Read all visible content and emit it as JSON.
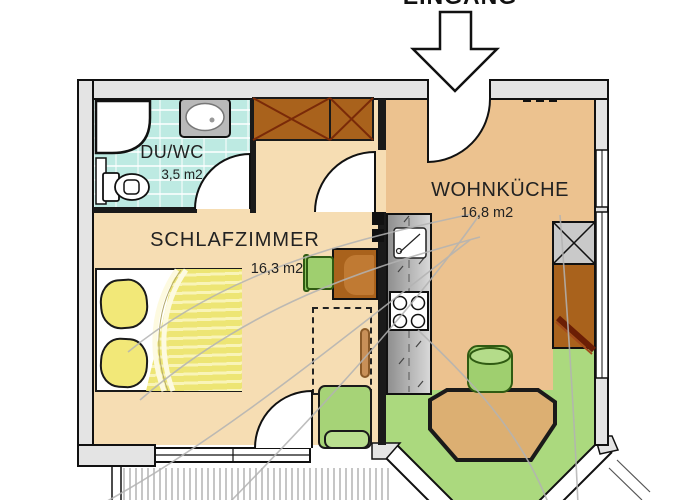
{
  "plan_title": "apartment floor plan",
  "entrance": {
    "label": "EINGANG"
  },
  "rooms": {
    "bath": {
      "name": "DU/WC",
      "area": "3,5 m2"
    },
    "bedroom": {
      "name": "SCHLAFZIMMER",
      "area": "16,3 m2"
    },
    "kitchen": {
      "name": "WOHNKÜCHE",
      "area": "16,8 m2"
    }
  },
  "colors": {
    "wall_fill": "#E4E4E4",
    "wall_line": "#1A1A1A",
    "floor_bedroom": "#F6DDB3",
    "floor_kitchen": "#ECC28F",
    "floor_bath_tile": "#BDEAE2",
    "floor_green": "#ABD97E",
    "furniture_brown": "#A9621C",
    "furniture_green": "#A6D377",
    "bed_yellow": "#F2E878",
    "counter_gray": "#B5B5B5",
    "table_tan": "#DCAF72"
  }
}
